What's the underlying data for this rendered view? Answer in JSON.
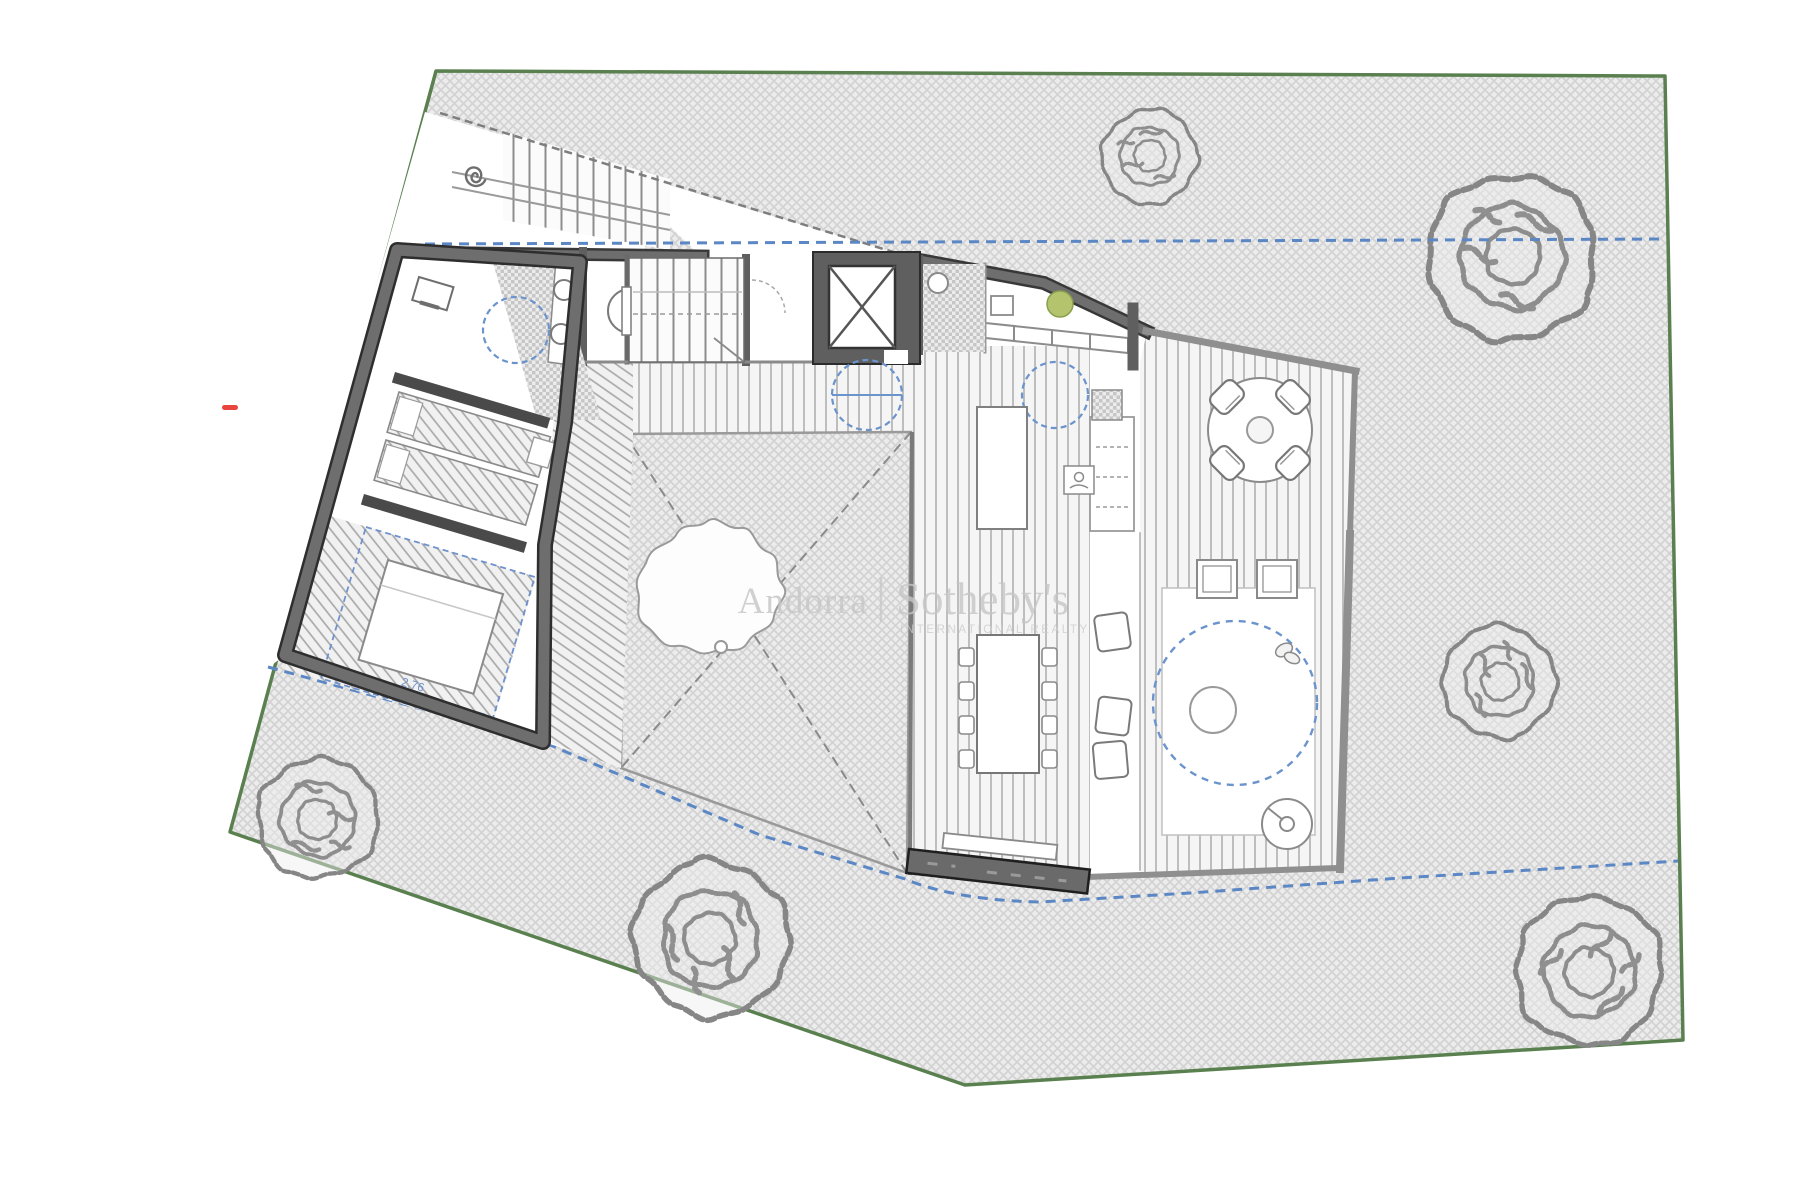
{
  "watermark": {
    "brand_left": "Andorra",
    "divider": "|",
    "brand_right": "Sotheby's",
    "tagline": "INTERNATIONAL REALTY"
  },
  "annotations": {
    "bed_dimension": "2.76"
  },
  "colors": {
    "site_boundary_green": "#5a8050",
    "setback_blue": "#5b87c5",
    "marker_red": "#e8453f",
    "plant_green": "#b4c36e",
    "dimension_blue": "#6f92cc",
    "watermark_gray": "#c6c6c6",
    "wall_gray": "#5f5f5f"
  }
}
